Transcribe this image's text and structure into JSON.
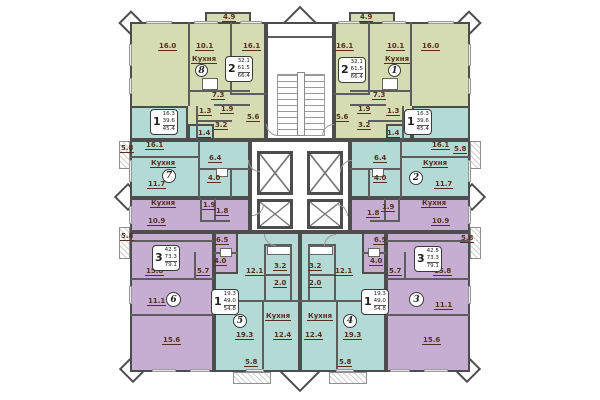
{
  "palette": {
    "green": "#d5dcb2",
    "teal": "#b4dad5",
    "purple": "#c6aed2",
    "white": "#ffffff",
    "wall": "#4d4d4d",
    "partition": "#5d5d5d",
    "label_text": "#552f1f"
  },
  "kitchen_text": "Кухня",
  "apartments": [
    {
      "number": "8",
      "zone": "green",
      "rooms_count": "2",
      "areas": {
        "living": "32.1",
        "total": "61.5",
        "total_with_balcony": "66.4"
      },
      "room_areas": [
        "16.0",
        "10.1",
        "16.1",
        "7.3",
        "1.3",
        "1.9",
        "3.2",
        "5.6",
        "4.9"
      ]
    },
    {
      "number": "1",
      "zone": "green",
      "rooms_count": "2",
      "areas": {
        "living": "32.1",
        "total": "61.5",
        "total_with_balcony": "66.4"
      },
      "room_areas": [
        "16.0",
        "10.1",
        "16.1",
        "7.3",
        "1.3",
        "1.9",
        "3.2",
        "5.6",
        "4.9"
      ]
    },
    {
      "number": "7",
      "zone": "teal",
      "rooms_count": "1",
      "areas": {
        "living": "16.3",
        "total": "39.6",
        "total_with_balcony": "45.4"
      },
      "room_areas": [
        "16.1",
        "11.7",
        "6.4",
        "4.0",
        "1.4",
        "5.8"
      ]
    },
    {
      "number": "2",
      "zone": "teal",
      "rooms_count": "1",
      "areas": {
        "living": "16.3",
        "total": "39.6",
        "total_with_balcony": "45.4"
      },
      "room_areas": [
        "16.1",
        "11.7",
        "6.4",
        "4.0",
        "1.4",
        "5.8"
      ]
    },
    {
      "number": "6",
      "zone": "purple",
      "rooms_count": "3",
      "areas": {
        "living": "42.5",
        "total": "73.3",
        "total_with_balcony": "79.1"
      },
      "room_areas": [
        "10.9",
        "15.8",
        "11.1",
        "15.6",
        "6.5",
        "5.7",
        "4.0",
        "1.9",
        "1.8",
        "5.8"
      ]
    },
    {
      "number": "3",
      "zone": "purple",
      "rooms_count": "3",
      "areas": {
        "living": "42.5",
        "total": "73.3",
        "total_with_balcony": "79.1"
      },
      "room_areas": [
        "10.9",
        "15.8",
        "11.1",
        "15.6",
        "6.5",
        "5.7",
        "4.0",
        "1.9",
        "1.8",
        "5.8"
      ]
    },
    {
      "number": "5",
      "zone": "teal",
      "rooms_count": "1",
      "areas": {
        "living": "19.3",
        "total": "49.0",
        "total_with_balcony": "54.8"
      },
      "room_areas": [
        "19.3",
        "12.4",
        "12.1",
        "3.2",
        "2.0",
        "5.8"
      ]
    },
    {
      "number": "4",
      "zone": "teal",
      "rooms_count": "1",
      "areas": {
        "living": "19.3",
        "total": "49.0",
        "total_with_balcony": "54.8"
      },
      "room_areas": [
        "19.3",
        "12.4",
        "12.1",
        "3.2",
        "2.0",
        "5.8"
      ]
    }
  ],
  "labels": {
    "g8_balc": "4.9",
    "g8_r1": "16.0",
    "g8_kitA": "10.1",
    "g8_kit": "Кухня",
    "g8_r2": "16.1",
    "g8_hall": "7.3",
    "g8_wc": "1.3",
    "g8_bath": "1.9",
    "g8_s": "3.2",
    "g8_r3": "5.6",
    "g1_balc": "4.9",
    "g1_r1": "16.1",
    "g1_kitA": "10.1",
    "g1_kit": "Кухня",
    "g1_r2": "16.0",
    "g1_hall": "7.3",
    "g1_bath": "1.9",
    "g1_wc": "1.3",
    "g1_s": "3.2",
    "g1_r3": "5.6",
    "t7_s": "1.4",
    "t7_balc": "5.8",
    "t7_r1": "16.1",
    "t7_kit": "Кухня",
    "t7_kitA": "11.7",
    "t7_hall": "6.4",
    "t7_bath": "4.0",
    "t2_s": "1.4",
    "t2_balc": "5.8",
    "t2_r1": "16.1",
    "t2_kit": "Кухня",
    "t2_kitA": "11.7",
    "t2_hall": "6.4",
    "t2_bath": "4.0",
    "p6_kit": "Кухня",
    "p6_b1": "1.9",
    "p6_b2": "1.8",
    "p6_kitA": "10.9",
    "p6_balc1": "5.8",
    "p6_h1": "6.5",
    "p6_bath": "4.0",
    "p6_r1": "15.8",
    "p6_h2": "5.7",
    "p6_r2": "11.1",
    "p6_r3": "15.6",
    "p3_kit": "Кухня",
    "p3_b1": "1.9",
    "p3_b2": "1.8",
    "p3_kitA": "10.9",
    "p3_balc1": "5.8",
    "p3_h1": "6.5",
    "p3_bath": "4.0",
    "p3_r1": "15.8",
    "p3_h2": "5.7",
    "p3_r2": "11.1",
    "p3_r3": "15.6",
    "t5_hall": "12.1",
    "t5_s1": "3.2",
    "t5_s2": "2.0",
    "t5_kit": "Кухня",
    "t5_r1": "19.3",
    "t5_kitA": "12.4",
    "t5_balc": "5.8",
    "t4_hall": "12.1",
    "t4_s1": "3.2",
    "t4_s2": "2.0",
    "t4_kit": "Кухня",
    "t4_r1": "19.3",
    "t4_kitA": "12.4",
    "t4_balc": "5.8"
  }
}
